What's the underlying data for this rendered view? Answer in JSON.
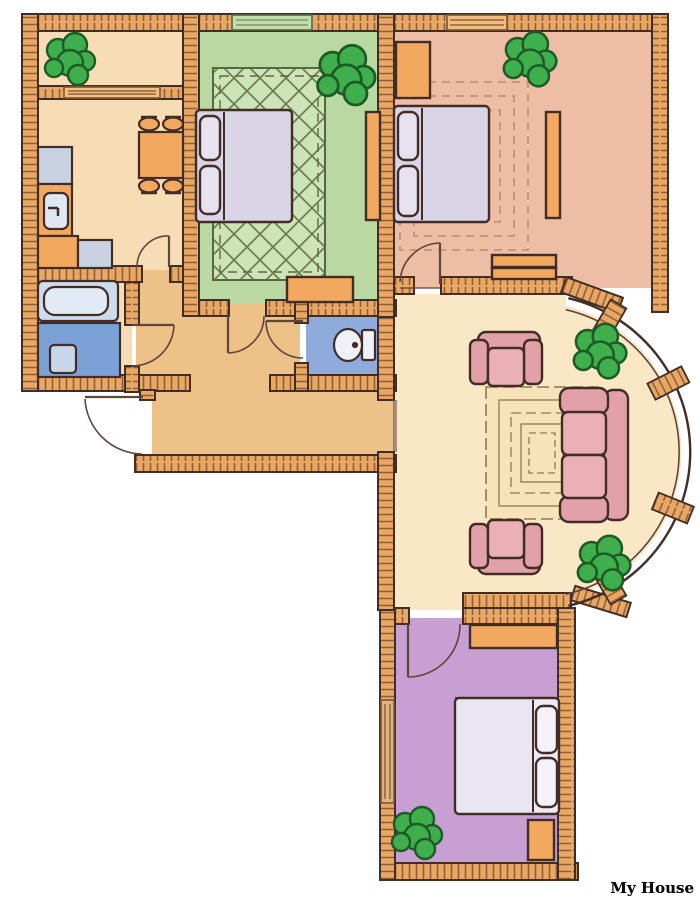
{
  "title": "My House",
  "palette": {
    "wall_fill": "#e9a766",
    "wall_hatch": "#8f5f33",
    "outline": "#422d26",
    "line": "#5f463a",
    "window_fill": "#f2bd7e",
    "window_green": "#c3dcae",
    "window_line": "#7a5634",
    "plant_fill": "#3fae4c",
    "plant_outline": "#1d5a26",
    "wood": "#f2a85f",
    "bed_linen": "#d9d4e6",
    "pillow": "#e6e2f0",
    "white_linen": "#edeaf4",
    "blanket_purple_room": "#e9e6f1",
    "sofa": "#e2a0a8",
    "sofa_light": "#eab0b5",
    "tub": "#ccdcee",
    "tub_inner": "#e2ebf5",
    "shower": "#7ba1d6",
    "shower_mat": "#c8d6ea",
    "counter_gray": "#c9d2e2",
    "sink": "#dfe7f2",
    "toilet": "#eef2f8",
    "rug_line_green": "#5c6a3f",
    "rug_line_pink": "#c08a6d",
    "rug_line_living": "#907753",
    "title_color": "#0b0b0b",
    "title_stroke": "#ffffff"
  },
  "rooms": {
    "balcony": {
      "floor": "#f7ddb6"
    },
    "kitchen": {
      "floor": "#f7ddb6"
    },
    "green_bedroom": {
      "floor": "#b9d8a2",
      "rug": "#cde3b8"
    },
    "pink_bedroom": {
      "floor": "#edbda6"
    },
    "living_room": {
      "floor": "#fae7c6"
    },
    "hallway": {
      "floor": "#edc188"
    },
    "bathroom": {
      "floor": "#f7ddb6"
    },
    "wc": {
      "floor": "#8fabdc"
    },
    "purple_bedroom": {
      "floor": "#c89fd2"
    }
  }
}
